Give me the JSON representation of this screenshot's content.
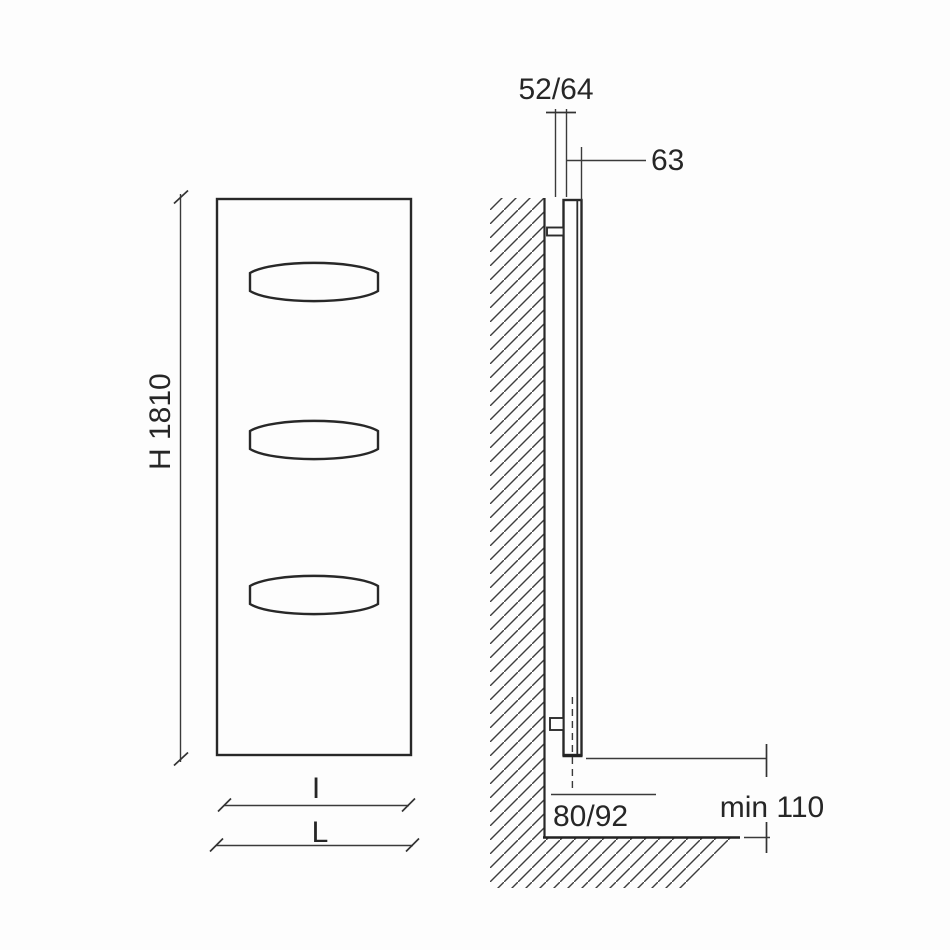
{
  "diagram": {
    "labels": {
      "height": "H 1810",
      "thickness": "52/64",
      "depth": "63",
      "inner_width": "I",
      "overall_width": "L",
      "pipe_offset": "80/92",
      "floor_clearance": "min 110"
    },
    "colors": {
      "background": "#fdfdfd",
      "outline": "#282828",
      "dimension_line": "#3a3a3a",
      "text": "#262626",
      "hatch": "#3d3d3d"
    }
  }
}
